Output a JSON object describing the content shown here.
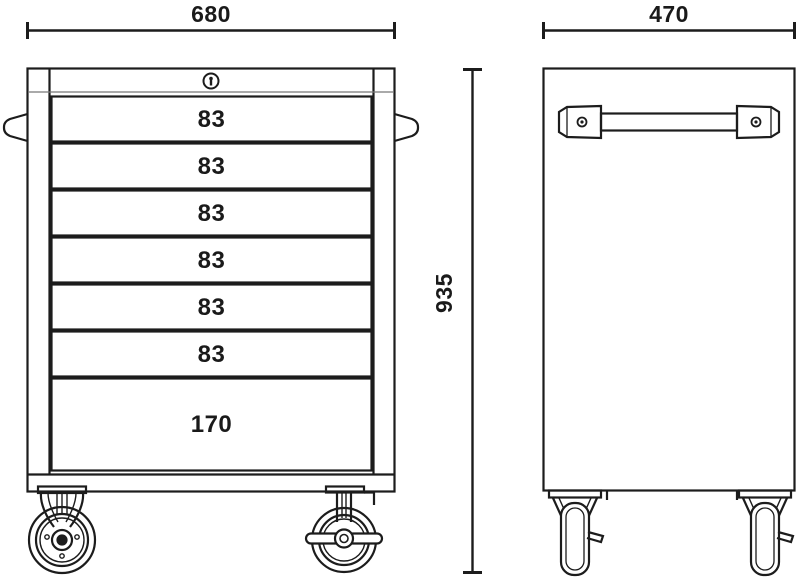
{
  "title": "Roller tool cabinet technical drawing",
  "colors": {
    "line": "#1c1c1c",
    "text": "#1a1a1a",
    "background": "#ffffff"
  },
  "dimensions": {
    "front_width": "680",
    "depth": "470",
    "height": "935"
  },
  "front_view": {
    "drawers": [
      "83",
      "83",
      "83",
      "83",
      "83",
      "83",
      "170"
    ]
  },
  "icons": {
    "lock": "keyhole-lock-icon",
    "front_left_caster": "swivel-caster-front-icon",
    "front_right_caster": "brake-caster-front-icon",
    "side_casters": "caster-side-icon",
    "handle": "side-handle-icon"
  }
}
